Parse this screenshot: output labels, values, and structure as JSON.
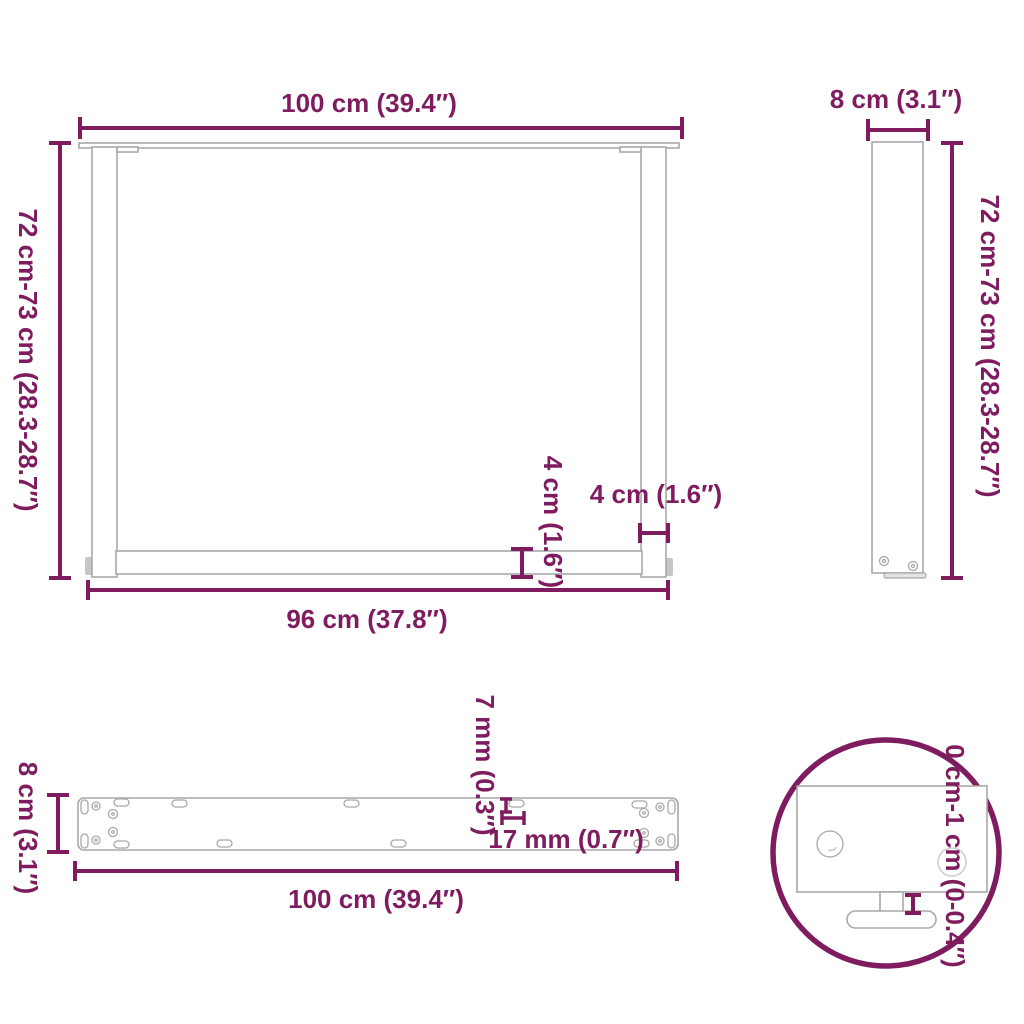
{
  "colors": {
    "dimension": "#7e1c5f",
    "outline": "#a8a8a8",
    "outline_light": "#cfcfcf",
    "fill_gray": "#c6c6c6",
    "background": "#ffffff"
  },
  "views": {
    "front": {
      "top_width_label": "100 cm (39.4″)",
      "left_height_label": "72 cm-73 cm (28.3-28.7″)",
      "bottom_width_label": "96 cm (37.8″)",
      "leg_width_label": "4 cm (1.6″)",
      "crossbar_height_label": "4 cm (1.6″)"
    },
    "side": {
      "top_width_label": "8 cm (3.1″)",
      "right_height_label": "72 cm-73 cm (28.3-28.7″)"
    },
    "plate": {
      "left_depth_label": "8 cm (3.1″)",
      "slot_height_label": "7 mm (0.3″)",
      "slot_width_label": "17 mm (0.7″)",
      "bottom_length_label": "100 cm (39.4″)"
    },
    "detail": {
      "adjust_range_label": "0 cm-1 cm (0-0.4″)"
    }
  }
}
